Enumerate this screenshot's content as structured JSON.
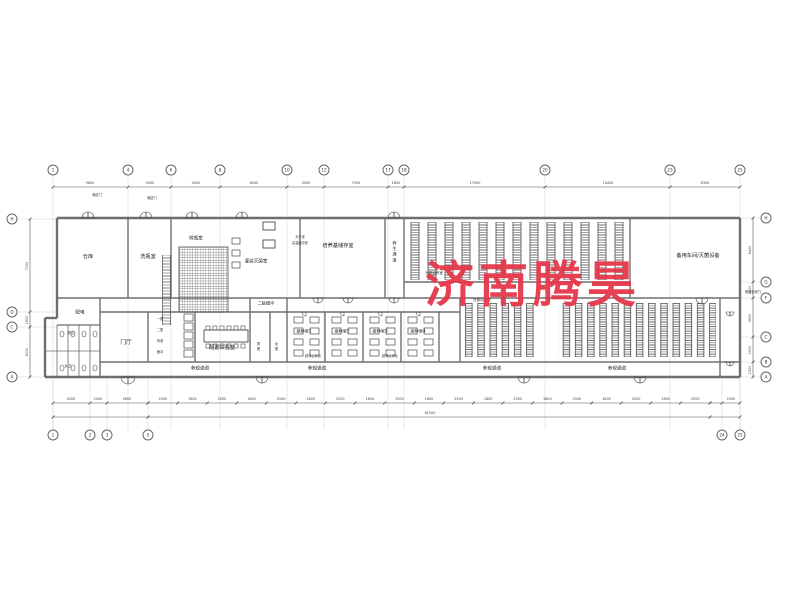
{
  "watermark": {
    "text": "济南腾昊",
    "color": "#e5384a"
  },
  "rooms": {
    "cangku": "仓库",
    "xipingshi": "洗瓶室",
    "liangpingshi": "晾瓶室",
    "guanzhuang_miejun": "灌装灭菌室",
    "peiyangji_chucun": "培养基储存室",
    "yangsheng_tongdao": "养生通道",
    "guangzhao_peiyang": "光照培养室",
    "beiyong_chejian": "备用车间/灭菌设备",
    "peidian": "配电",
    "nan_wei": "男卫",
    "nv_wei": "女卫",
    "menting": "门厅",
    "peizhi_shiyanshi": "配置实验室",
    "erji_huanchong": "二级缓冲",
    "nan_geng": "男更",
    "nv_geng": "女更",
    "jiezhong": [
      "接种室1",
      "接种室2",
      "接种室3",
      "接种室4"
    ],
    "canguan_tongdao": "参观通道"
  },
  "annotations": {
    "shusong_men": "输送门",
    "guandao_men": "管道检修门",
    "tianping": "天平室",
    "gaowen": "高温缓冲室",
    "chaojing": "超净工作台",
    "yigeng": "一更",
    "ergeng": "二更",
    "fenglin": "风淋",
    "huanchong": "缓冲"
  },
  "axes": {
    "top": [
      {
        "label": "1",
        "x": 53
      },
      {
        "label": "4",
        "x": 128
      },
      {
        "label": "6",
        "x": 171
      },
      {
        "label": "8",
        "x": 220
      },
      {
        "label": "10",
        "x": 287
      },
      {
        "label": "12",
        "x": 324
      },
      {
        "label": "17",
        "x": 388
      },
      {
        "label": "18",
        "x": 404
      },
      {
        "label": "20",
        "x": 545
      },
      {
        "label": "23",
        "x": 670
      },
      {
        "label": "25",
        "x": 740
      }
    ],
    "bottom": [
      {
        "label": "1",
        "x": 53
      },
      {
        "label": "2",
        "x": 90
      },
      {
        "label": "3",
        "x": 107
      },
      {
        "label": "5",
        "x": 148
      },
      {
        "label": "24",
        "x": 722
      },
      {
        "label": "25",
        "x": 740
      }
    ],
    "left": [
      {
        "label": "H",
        "y": 219
      },
      {
        "label": "D",
        "y": 312
      },
      {
        "label": "C",
        "y": 327
      },
      {
        "label": "A",
        "y": 377
      }
    ],
    "right": [
      {
        "label": "H",
        "y": 218
      },
      {
        "label": "G",
        "y": 282
      },
      {
        "label": "F",
        "y": 298
      },
      {
        "label": "C",
        "y": 337
      },
      {
        "label": "B",
        "y": 362
      },
      {
        "label": "A",
        "y": 377
      }
    ]
  },
  "dims": {
    "top": [
      {
        "text": "9800",
        "x": 90
      },
      {
        "text": "5000",
        "x": 150
      },
      {
        "text": "4000",
        "x": 196
      },
      {
        "text": "8000",
        "x": 254
      },
      {
        "text": "4500",
        "x": 306
      },
      {
        "text": "7500",
        "x": 356
      },
      {
        "text": "1800",
        "x": 396
      },
      {
        "text": "17500",
        "x": 475
      },
      {
        "text": "14400",
        "x": 608
      },
      {
        "text": "8300",
        "x": 705
      }
    ],
    "left": [
      {
        "text": "7200",
        "y": 266
      },
      {
        "text": "1800",
        "y": 320
      },
      {
        "text": "6000",
        "y": 352
      }
    ],
    "right": [
      {
        "text": "6400",
        "y": 250
      },
      {
        "text": "1800",
        "y": 290
      },
      {
        "text": "3900",
        "y": 318
      },
      {
        "text": "2500",
        "y": 350
      },
      {
        "text": "1500",
        "y": 370
      }
    ],
    "bottom_left": [
      {
        "text": "4300",
        "x": 71
      },
      {
        "text": "2000",
        "x": 98
      },
      {
        "text": "5600",
        "x": 127
      }
    ],
    "bottom_run": [
      "2500",
      "1800",
      "2500",
      "1800",
      "2500",
      "1800",
      "2500",
      "1800",
      "2500",
      "1800",
      "2500",
      "1800",
      "2500",
      "1800",
      "2500",
      "1800",
      "2500",
      "1800",
      "2500"
    ],
    "bottom_right": {
      "text": "2500",
      "x": 731
    },
    "bottom_total": {
      "text": "61500",
      "x": 430
    }
  }
}
